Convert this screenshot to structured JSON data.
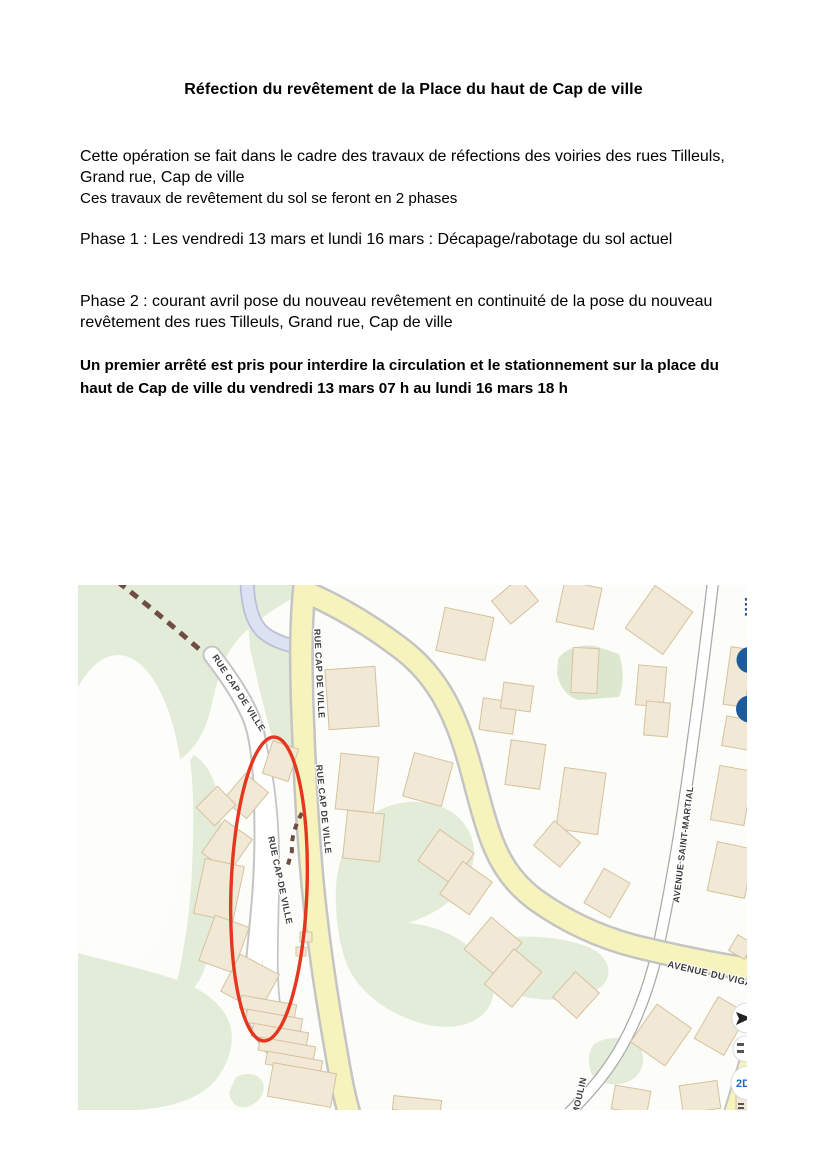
{
  "document": {
    "title": "Réfection du revêtement de la Place du haut de Cap de ville",
    "intro": "Cette opération se fait dans le cadre des travaux de réfections des voiries des rues Tilleuls, Grand rue, Cap de ville",
    "intro_line2": "Ces travaux de revêtement du sol se feront en 2 phases",
    "phase1": "Phase 1 : Les vendredi 13 mars et lundi 16 mars : Décapage/rabotage du sol actuel",
    "phase2": "Phase 2 : courant avril pose du nouveau revêtement en continuité de la pose du nouveau revêtement des rues Tilleuls, Grand rue, Cap de ville",
    "notice": "Un premier arrêté est pris pour interdire la circulation et le stationnement sur la place du haut de Cap de ville du vendredi 13 mars 07 h au lundi 16 mars 18 h"
  },
  "map": {
    "street_labels": {
      "rue_cap_de_ville": "RUE CAP DE VILLE",
      "avenue_saint_martial": "AVENUE SAINT-MARTIAL",
      "avenue_du_vigan": "AVENUE DU VIGAN",
      "moulin": "MOULIN"
    },
    "controls": {
      "view_2d_label": "2D"
    },
    "colors": {
      "green_area": "#e3ecd8",
      "road_yellow": "#f7f3bd",
      "road_white": "#ffffff",
      "road_blue": "#dde2f2",
      "road_casing": "#c4c4c4",
      "building_fill": "#f1e8d5",
      "building_stroke": "#d5c2a0",
      "annotation_red": "#e53620",
      "poi_blue": "#1c5c9e",
      "path_brown": "#6f4c44"
    }
  }
}
